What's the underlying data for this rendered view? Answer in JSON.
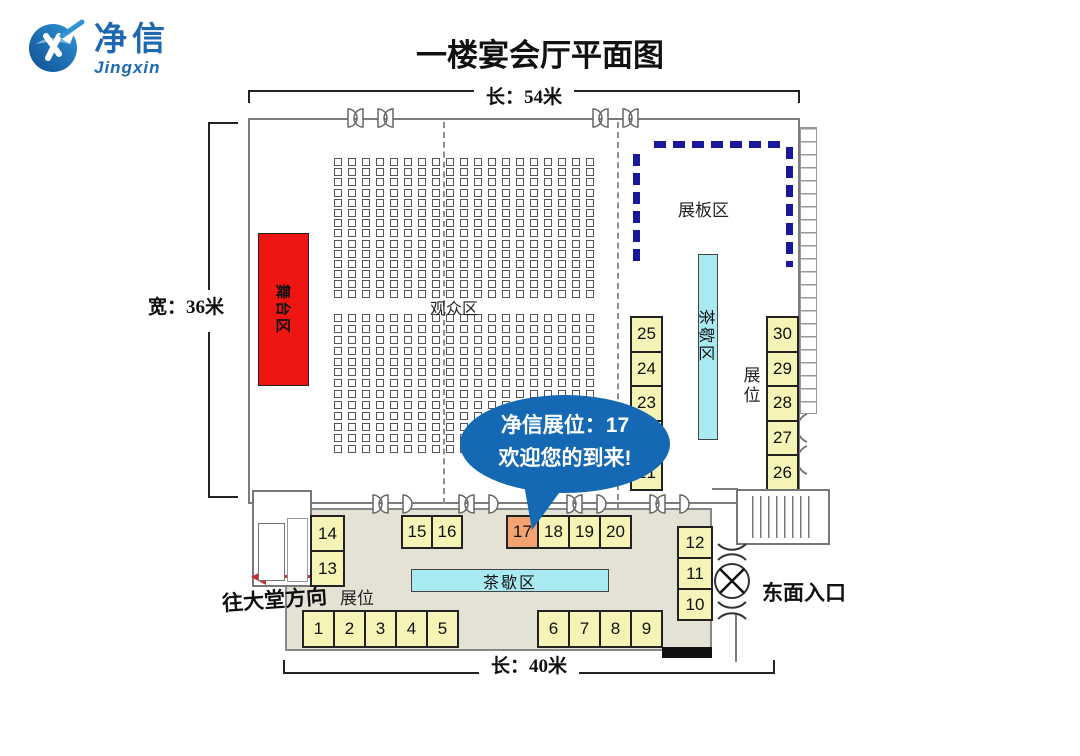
{
  "logo": {
    "cn": "净信",
    "en": "Jingxin"
  },
  "title": "一楼宴会厅平面图",
  "dims": {
    "top": "长：54米",
    "left": "宽：36米",
    "bottom": "长：40米"
  },
  "areas": {
    "stage": "舞台区",
    "audience": "观众区",
    "board": "展板区",
    "tea_vertical": "茶歇区",
    "tea_horizontal": "茶歇区",
    "booths_right": "展位",
    "booths_foyer": "展位",
    "east_entrance": "东面入口",
    "to_lobby": "往大堂方向"
  },
  "callout": {
    "line1": "净信展位：17",
    "line2": "欢迎您的到来!"
  },
  "booths": {
    "highlighted": "17",
    "col_21_25": [
      "25",
      "24",
      "23",
      "22",
      "21"
    ],
    "col_26_30": [
      "30",
      "29",
      "28",
      "27",
      "26"
    ],
    "pair_13_14": [
      "14",
      "13"
    ],
    "row_15_16": [
      "15",
      "16"
    ],
    "row_17_20": [
      "17",
      "18",
      "19",
      "20"
    ],
    "col_10_12": [
      "12",
      "11",
      "10"
    ],
    "row_1_5": [
      "1",
      "2",
      "3",
      "4",
      "5"
    ],
    "row_6_9": [
      "6",
      "7",
      "8",
      "9"
    ]
  },
  "seating": {
    "top_block": {
      "rows": 14,
      "cols": 19
    },
    "bottom_block": {
      "rows": 13,
      "cols": 19
    }
  },
  "colors": {
    "logo_blue": "#1d69b0",
    "stage_red": "#ee1512",
    "tea_cyan": "#a9e9f2",
    "booth_yellow": "#f6f3b6",
    "booth_highlight": "#f3a271",
    "bubble_blue": "#1468b4",
    "board_navy": "#1a189a",
    "arrow_red": "#c2302a",
    "foyer_bg": "#e4e2d4"
  }
}
